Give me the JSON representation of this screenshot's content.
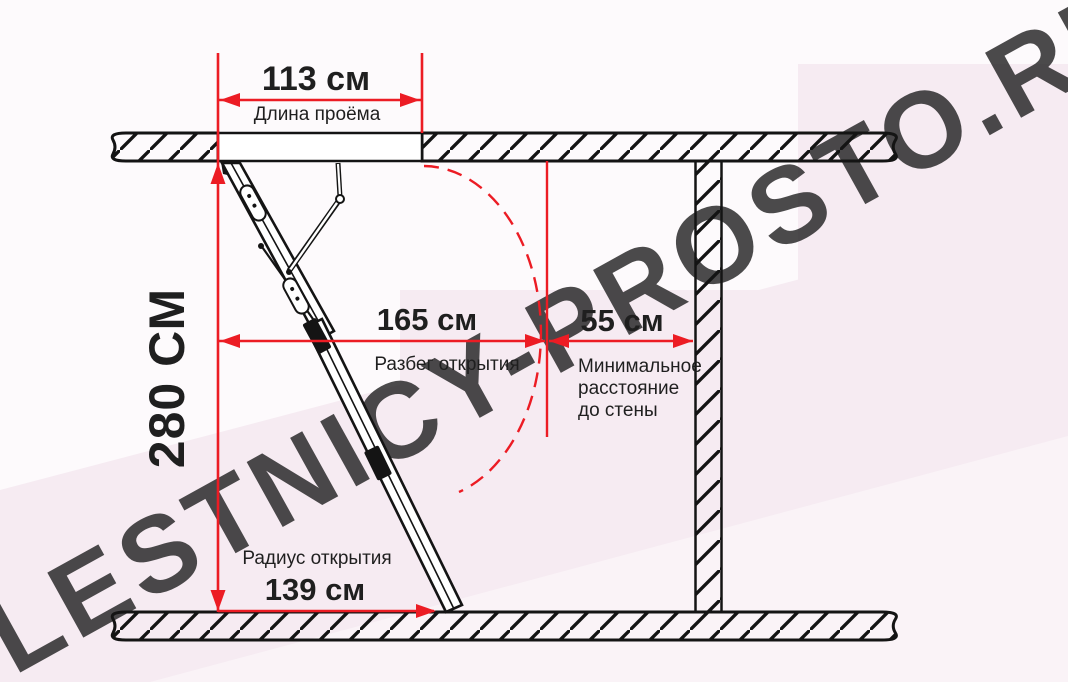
{
  "watermark": {
    "text": "LESTNICY-PROSTO.RU"
  },
  "dims": {
    "opening_length": {
      "value": "113 см",
      "label": "Длина проёма"
    },
    "height": {
      "value": "280 СМ"
    },
    "span": {
      "value": "165 см",
      "label": "Разбег открытия"
    },
    "wall_gap": {
      "value": "55 см",
      "label_line1": "Минимальное",
      "label_line2": "расстояние",
      "label_line3": "до стены"
    },
    "radius": {
      "value": "139 см",
      "label": "Радиус открытия"
    }
  },
  "colors": {
    "accent_red": "#ec1c24",
    "ink": "#141414",
    "text": "#1f1f1f",
    "background": "#fdfafc",
    "background_pink": "#f6ebf2",
    "watermark": "#e9dce4"
  }
}
